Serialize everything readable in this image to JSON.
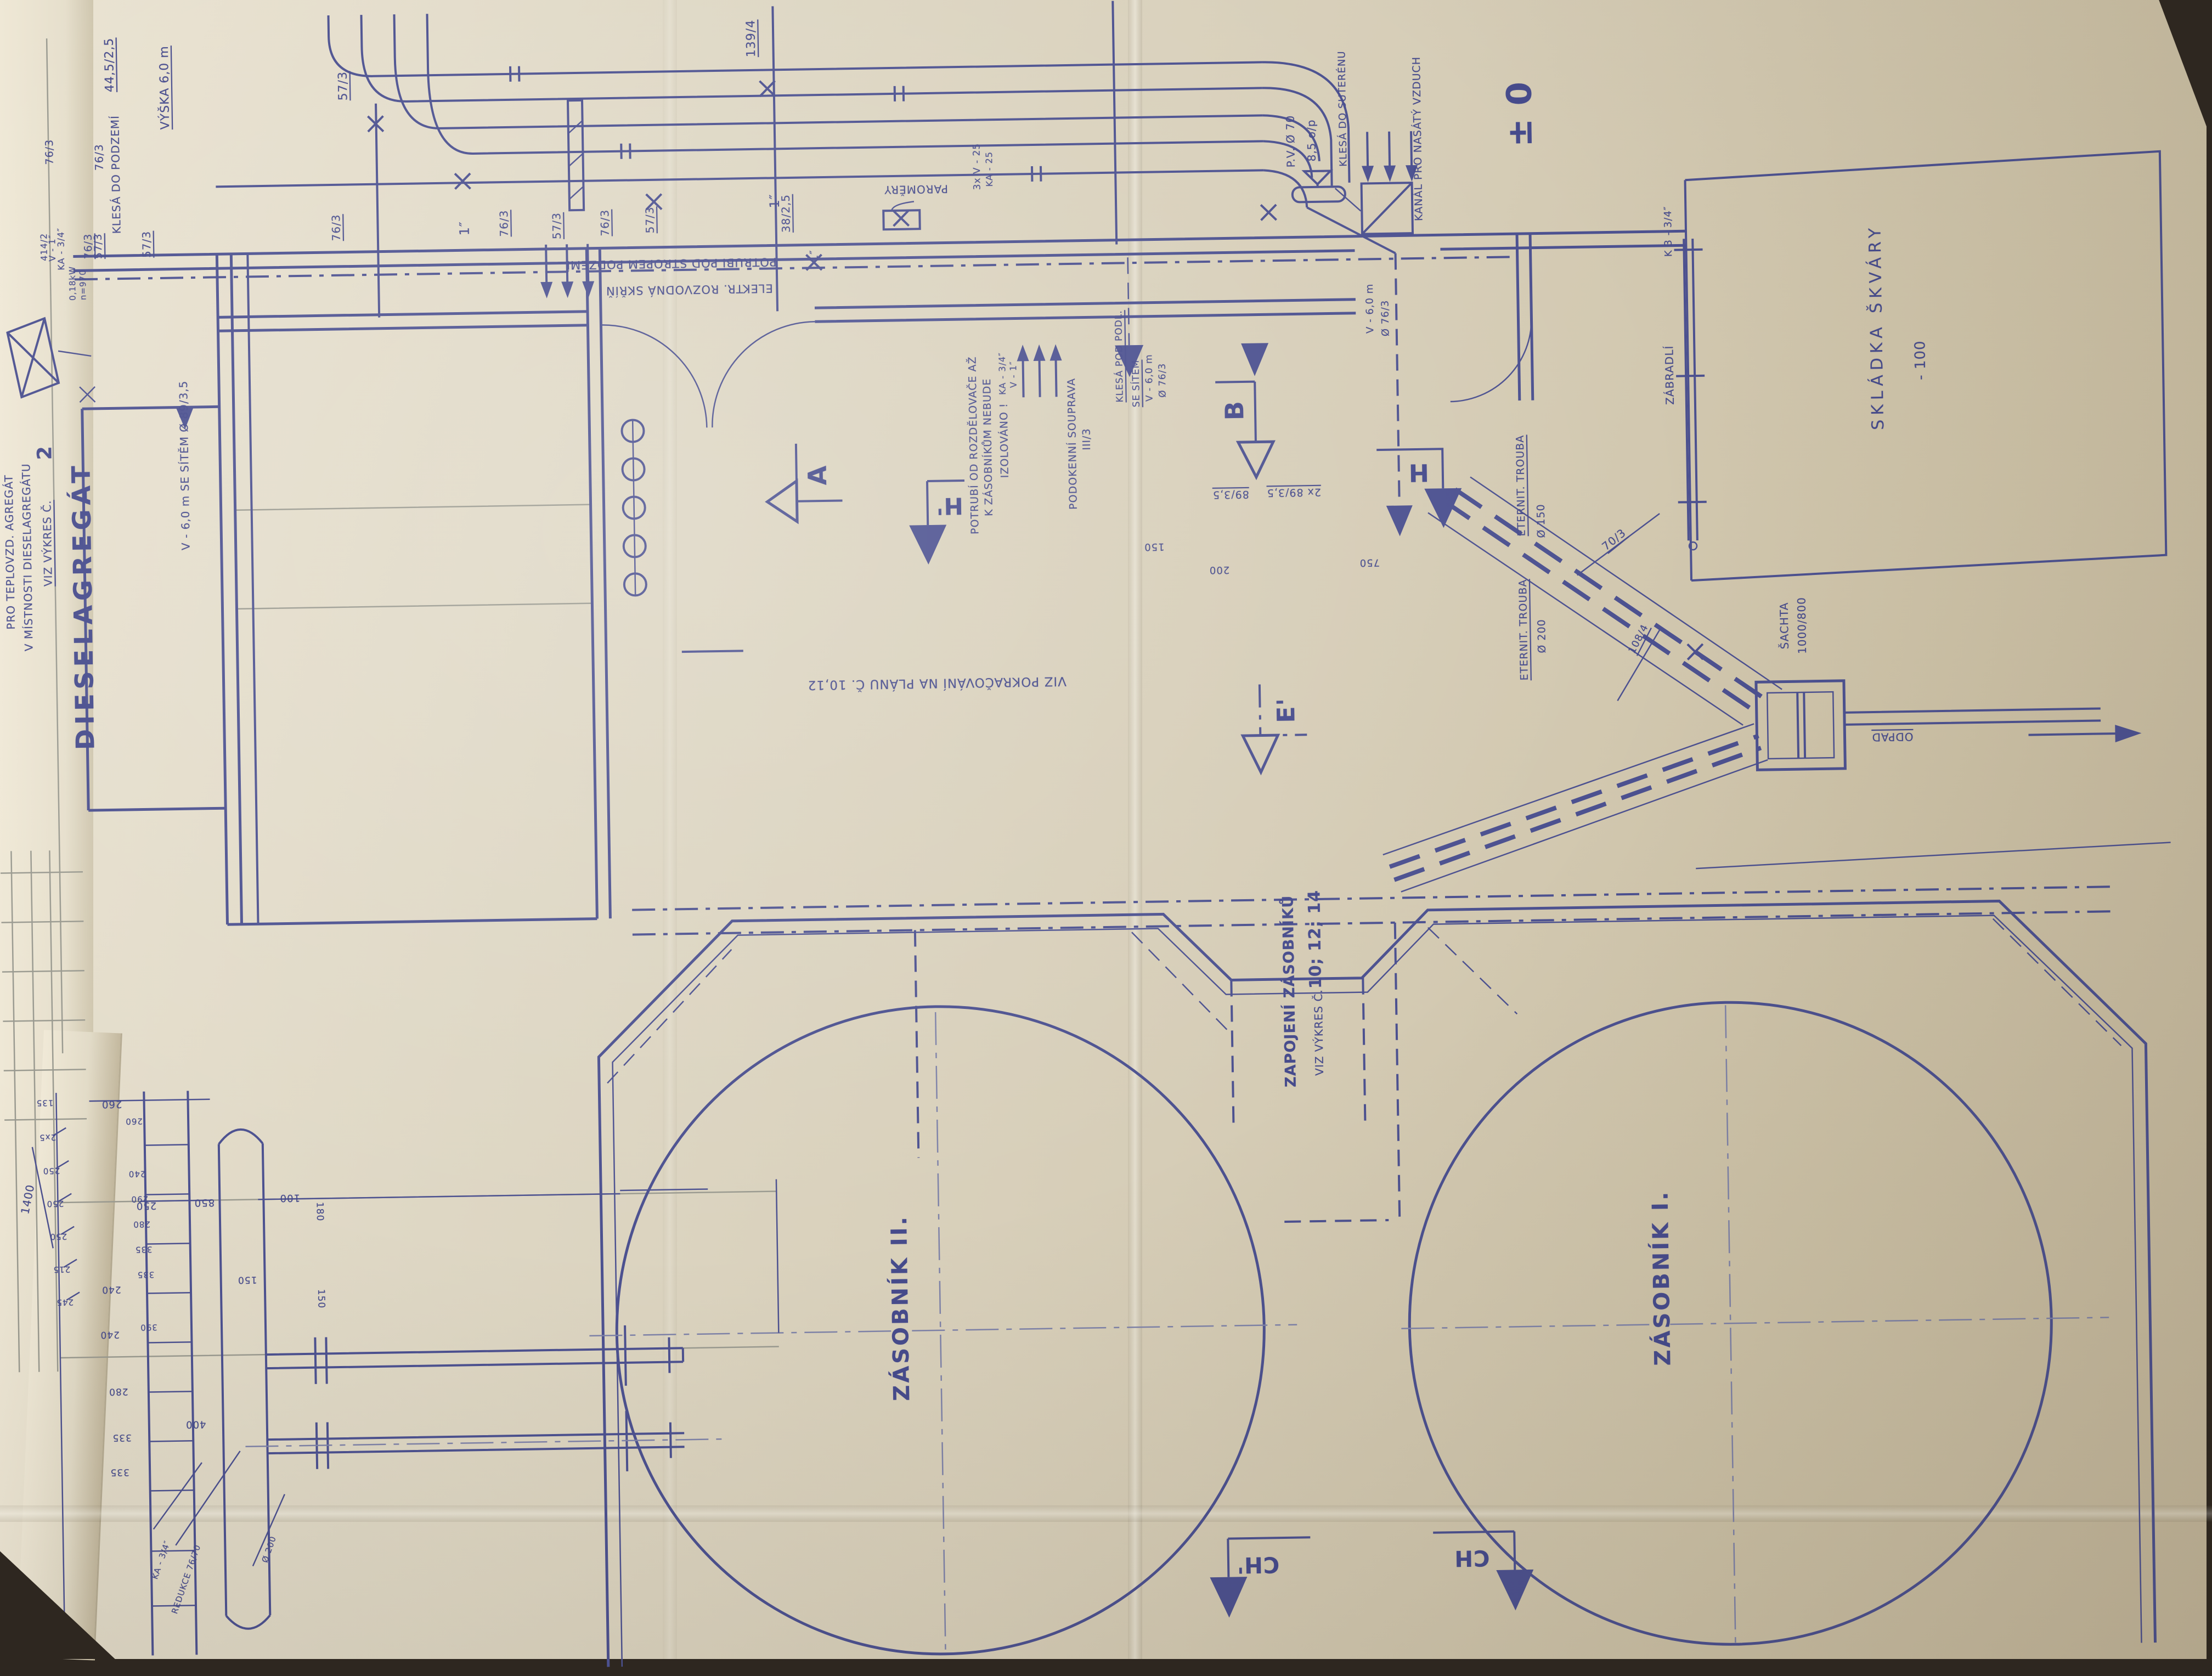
{
  "colors": {
    "ink": "#4c5190",
    "paper": "#d6cdb7",
    "undersheet": "#efe8d6",
    "table": "#2e2720"
  },
  "labels": {
    "dieselagregat": "DIESELAGREGÁT",
    "note1": "PRO TEPLOVZD. AGREGÁT",
    "note2": "V MÍSTNOSTI DIESELAGREGÁTU",
    "note3": "VIZ VÝKRES Č.",
    "note3_num": "2",
    "v6_sitem": "V - 6,0 m   SE SÍTĚM Ø 89/3,5",
    "dim_44": "44,5/2,5",
    "klesa_podzemi": "KLESÁ DO PODZEMÍ",
    "dim_76": "76/3",
    "dim_57": "57/3",
    "vyska6": "VÝŠKA 6,0 m",
    "dim_414": "414/2",
    "v_1": "V - 1″",
    "ka_34": "KA - 3/4″",
    "motor_kw": "0,18kW",
    "motor_n": "n=970",
    "dim_139": "139/4",
    "dim_1in": "1″",
    "dim_38": "38/2,5",
    "paromery": "PAROMĚRY",
    "v_25": "3x V - 25",
    "ka_25": "KA - 25",
    "potrubi_strop": "POTRUBÍ POD STROPEM PODZEMÍ",
    "elektr_skrin": "ELEKTR. ROZVODNÁ SKŘÍŇ",
    "pv_70": "P.V. Ø 70",
    "spad": "8,5 o/p",
    "klesa_suterenu": "KLESÁ DO SUTERÉNU",
    "kanal_vzduch": "KANÁL PRO NASÁTÝ VZDUCH",
    "pm_0": "± 0",
    "v_60": "V - 6,0 m",
    "dim_f76": "Ø 76/3",
    "potrubi_od1": "POTRUBÍ OD ROZDĚLOVAČE AŽ",
    "potrubi_od2": "K ZÁSOBNÍKŮM NEBUDE",
    "potrubi_od3": "IZOLOVÁNO !",
    "podokenni": "PODOKENNÍ SOUPRAVA",
    "podokenni_c": "III/3",
    "klesa_podl": "KLESÁ POD PODL.",
    "se_sitem": "SE SÍTĚM",
    "dim_89": "89/3,5",
    "dim_2x89": "2x 89/3,5",
    "dim_200": "200",
    "dim_750": "750",
    "dim_150": "150",
    "viz_pokr": "VIZ POKRAČOVÁNÍ NA PLÁNU Č. 10,12",
    "eternit": "ETERNIT. TROUBA",
    "dim_f150": "Ø 150",
    "dim_f200": "Ø 200",
    "dim_70": "70/3",
    "dim_108": "108/4",
    "zabradli": "ZÁBRADLÍ",
    "k3_34": "K 3 - 3/4″",
    "skladka": "SKLÁDKA ŠKVÁRY",
    "minus100": "- 100",
    "sachta": "ŠACHTA",
    "sachta_dim": "1000/800",
    "odpad": "ODPAD",
    "zapojeni": "ZAPOJENÍ ZÁSOBNÍKŮ",
    "zapojeni_viz": "VIZ VÝKRES Č.",
    "zapojeni_c": "10; 12; 14",
    "zasobnik2": "ZÁSOBNÍK II.",
    "zasobnik1": "ZÁSOBNÍK I.",
    "dim_260": "260",
    "dim_250": "250",
    "dim_850": "850",
    "dim_100": "100",
    "dim_240": "240",
    "dim_280": "280",
    "dim_400": "400",
    "dim_335": "335",
    "dim_135": "135",
    "dim_2x5": "2x5",
    "dim_215": "215",
    "dim_245": "245",
    "dim_1400": "1400",
    "dim_290": "290",
    "dim_390": "390",
    "dim_180": "180",
    "redukce": "REDUKCE 76/70"
  },
  "markers": {
    "a": "A",
    "b": "B",
    "h": "H",
    "h1": "H'",
    "e1": "E'",
    "ch": "CH",
    "ch1": "CH'"
  }
}
